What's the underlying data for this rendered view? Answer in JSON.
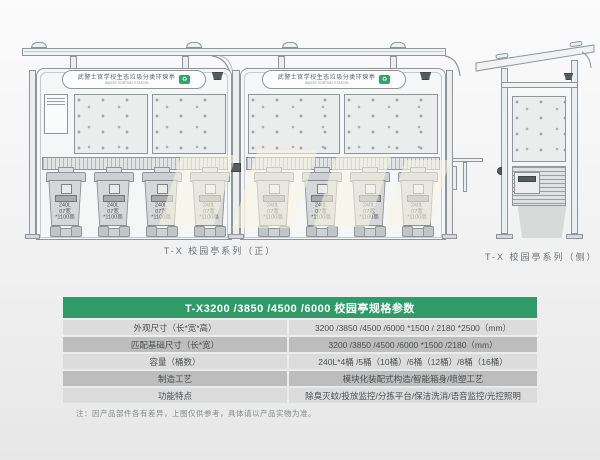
{
  "sign": {
    "cn": "武警士官学校生态垃圾分类环保亭",
    "en": "WASTE SORTING STATION"
  },
  "front_view": {
    "caption": "T-X 校园亭系列（正）",
    "bin_label_lines": [
      "240L",
      "07宽",
      "*1100高"
    ],
    "bin_count": 8
  },
  "side_view": {
    "caption": "T-X 校园亭系列（侧）"
  },
  "spec_table": {
    "title": "T-X3200 /3850 /4500 /6000 校园亭规格参数",
    "rows": [
      {
        "label": "外观尺寸（长*宽*高）",
        "value": "3200 /3850 /4500 /6000 *1500 / 2180 *2500（mm）"
      },
      {
        "label": "匹配基础尺寸（长*宽）",
        "value": "3200 /3850 /4500 /6000 *1500 /2180（mm）"
      },
      {
        "label": "容量（桶数）",
        "value": "240L*4桶 /5桶（10桶）/6桶（12桶）/8桶（16桶）"
      },
      {
        "label": "制造工艺",
        "value": "模块化装配式构造/智能箱身/喷塑工艺"
      },
      {
        "label": "功能特点",
        "value": "除臭灭蚊/投放监控/分拣平台/保洁洗消/语音监控/光控照明"
      }
    ],
    "note": "注：因产品部件各有差异，上图仅供参考，具体请以产品实物为准。",
    "colors": {
      "header_bg": "#2e9b68",
      "row_light": "#dcdcdc",
      "row_dark": "#bdbdbd",
      "logo_green": "#3aa06b"
    }
  },
  "icons": {
    "recycle": "♻"
  }
}
